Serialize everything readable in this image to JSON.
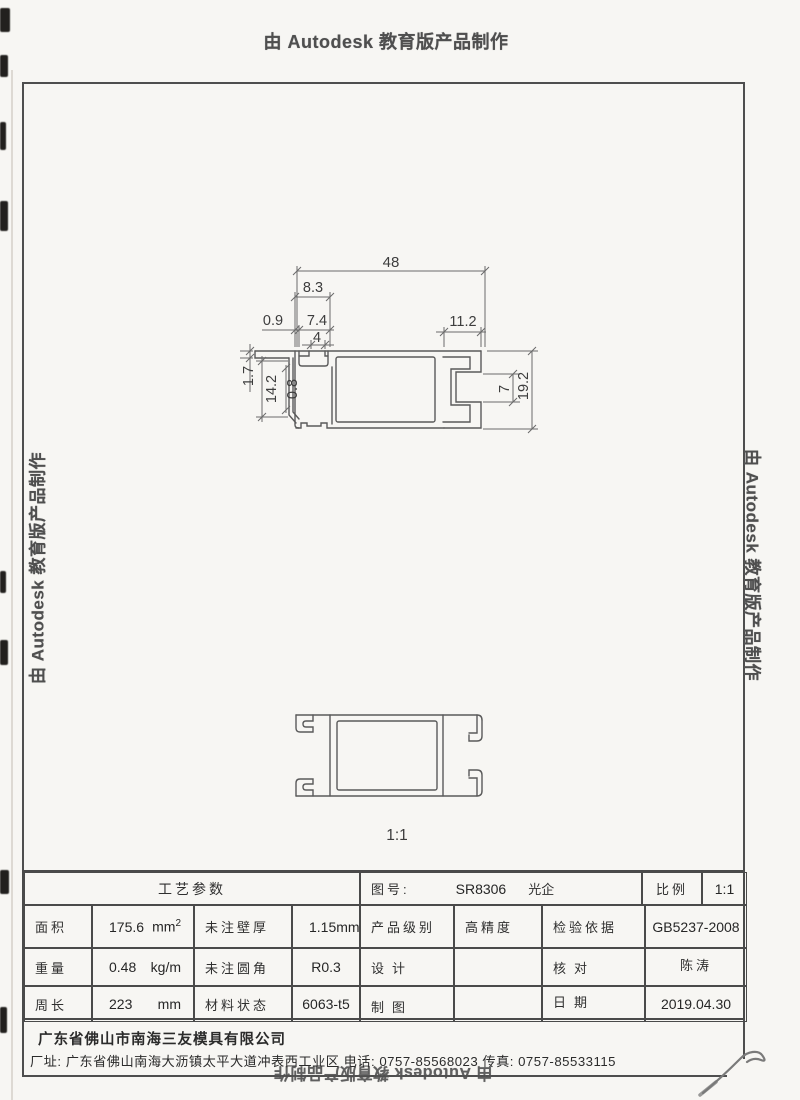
{
  "stamp_text": "由 Autodesk 教育版产品制作",
  "drawing": {
    "dim_width": "48",
    "dim_slot_outer": "8.3",
    "dim_wall_thin": "0.9",
    "dim_slot_inner": "7.4",
    "dim_notch_gap": "4",
    "dim_channel_width": "11.2",
    "dim_lip": "1.7",
    "dim_cavity_height": "14.2",
    "dim_inner_wall": "0.8",
    "dim_opening": "7",
    "dim_height": "19.2",
    "scale_caption": "1:1"
  },
  "title_block": {
    "process_header": "工艺参数",
    "fig_no_label": "图号:",
    "fig_no": "SR8306",
    "fig_name": "光企",
    "scale_label": "比例",
    "scale_value": "1:1",
    "area_label": "面积",
    "area_value": "175.6",
    "area_unit": "mm",
    "area_unit_exp": "2",
    "wall_label": "未注壁厚",
    "wall_value": "1.15",
    "wall_unit": "mm",
    "grade_label": "产品级别",
    "grade_value": "高精度",
    "standard_label": "检验依据",
    "standard_value": "GB5237-2008",
    "weight_label": "重量",
    "weight_value": "0.48",
    "weight_unit": "kg/m",
    "fillet_label": "未注圆角",
    "fillet_value": "R0.3",
    "design_label": "设计",
    "design_value": "",
    "check_label": "核对",
    "check_value": "陈涛",
    "perimeter_label": "周长",
    "perimeter_value": "223",
    "perimeter_unit": "mm",
    "material_label": "材料状态",
    "material_value": "6063-t5",
    "draft_label": "制图",
    "draft_value": "",
    "date_label": "日期",
    "date_value": "2019.04.30"
  },
  "company": {
    "name": "广东省佛山市南海三友模具有限公司",
    "address": "厂址: 广东省佛山南海大沥镇太平大道冲表西工业区  电话: 0757-85568023 传真: 0757-85533115"
  },
  "colors": {
    "ink": "#4f4f4f",
    "line": "#5a5a5a",
    "paper": "#f7f6f3"
  }
}
